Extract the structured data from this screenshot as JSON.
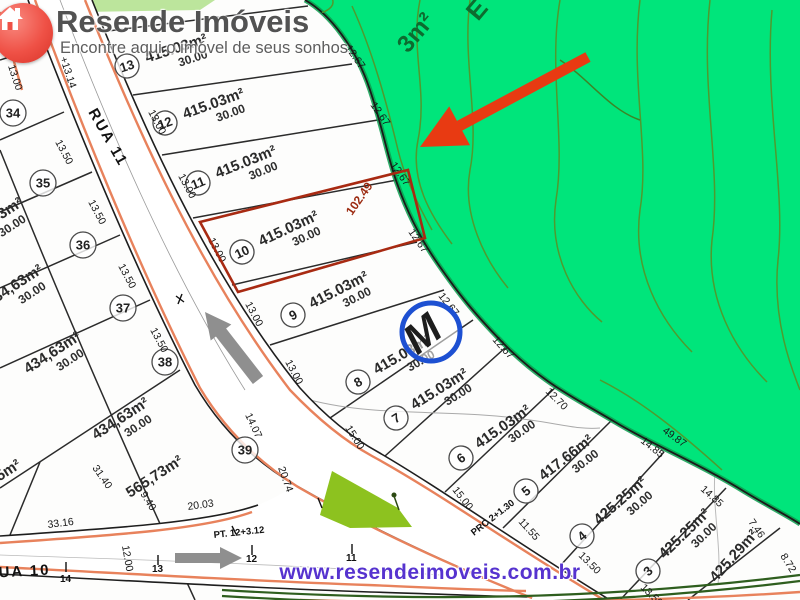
{
  "branding": {
    "title": "Resende Imóveis",
    "tagline": "Encontre aqui o imóvel de seus sonhos"
  },
  "footer": {
    "url": "www.resendeimoveis.com.br"
  },
  "map": {
    "streets": {
      "rua11": "RUA 11",
      "rua10": "RUA 10"
    },
    "green_labels": {
      "fragment_e": "E",
      "fragment_area": "3m²"
    },
    "highlight": {
      "dim": "102.49"
    },
    "marker": {
      "letter": "M"
    },
    "center_lots": [
      {
        "number": "13",
        "area": "415.03m²",
        "depth": "30.00"
      },
      {
        "number": "12",
        "area": "415.03m²",
        "depth": "30.00"
      },
      {
        "number": "11",
        "area": "415.03m²",
        "depth": "30.00"
      },
      {
        "number": "10",
        "area": "415.03m²",
        "depth": "30.00"
      },
      {
        "number": "9",
        "area": "415.03m²",
        "depth": "30.00"
      },
      {
        "number": "8",
        "area": "415.03m²",
        "depth": "30.00"
      },
      {
        "number": "7",
        "area": "415.03m²",
        "depth": "30.00"
      },
      {
        "number": "6",
        "area": "415.03m²",
        "depth": "30.00"
      },
      {
        "number": "5",
        "area": "417.66m²",
        "depth": "30.00"
      },
      {
        "number": "4",
        "area": "425.25m²",
        "depth": "30.00"
      },
      {
        "number": "3",
        "area": "425.25m²",
        "depth": "30.00"
      },
      {
        "number": "",
        "area": "425.29m²",
        "depth": ""
      }
    ],
    "left_lots": [
      {
        "number": "34",
        "area": "",
        "depth": ""
      },
      {
        "number": "35",
        "area": "434,63m²",
        "depth": "30.00"
      },
      {
        "number": "36",
        "area": "434,63m²",
        "depth": "30.00"
      },
      {
        "number": "37",
        "area": "434,63m²",
        "depth": "30.00"
      },
      {
        "number": "38",
        "area": "434,63m²",
        "depth": "30.00"
      },
      {
        "number": "39",
        "area": "565,73m²",
        "depth": ""
      },
      {
        "number": "",
        "area": "625,85m²",
        "depth": ""
      }
    ],
    "dims": [
      "12.67",
      "12.67",
      "12.67",
      "12.67",
      "12.67",
      "12.67",
      "12.70",
      "14.85",
      "14.85",
      "49.87",
      "7.46",
      "8.72",
      "13.00",
      "13.00",
      "13.00",
      "13.00",
      "13.00",
      "15.00",
      "15.00",
      "11.55",
      "13.50",
      "13.50",
      "13.50",
      "13.50",
      "13.50",
      "13.50",
      "14.07",
      "20.74",
      "9.40",
      "31.40",
      "33.16",
      "20.03",
      "12.00",
      "+13.14",
      "13.00"
    ],
    "stations": {
      "s14": "14",
      "s13": "13",
      "s12": "12",
      "s11": "11",
      "pt": "PT. 12+3.12",
      "prc": "PRC 2+1.30"
    }
  }
}
